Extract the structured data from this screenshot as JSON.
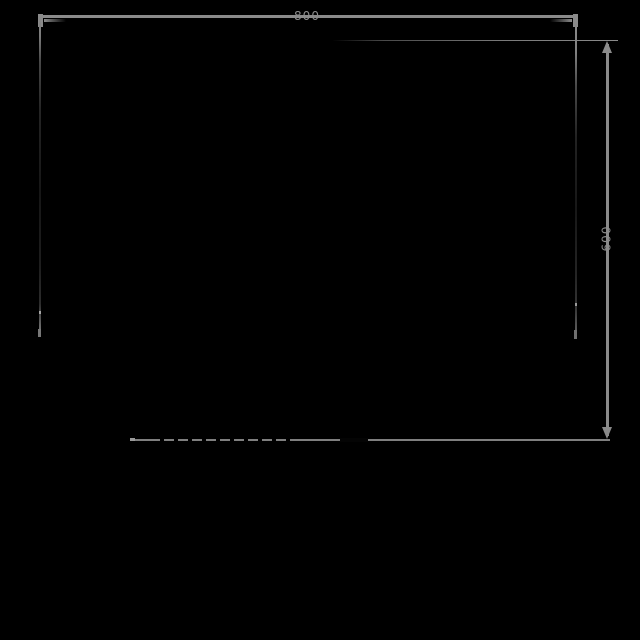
{
  "drawing": {
    "background_color": "#000000",
    "dimension_line_color": "#8a8a8a",
    "label_color": "#8c8c8c",
    "width_dimension": {
      "value": "800",
      "orientation": "horizontal",
      "position": "top"
    },
    "height_dimension": {
      "value": "600",
      "orientation": "vertical",
      "position": "right"
    }
  }
}
